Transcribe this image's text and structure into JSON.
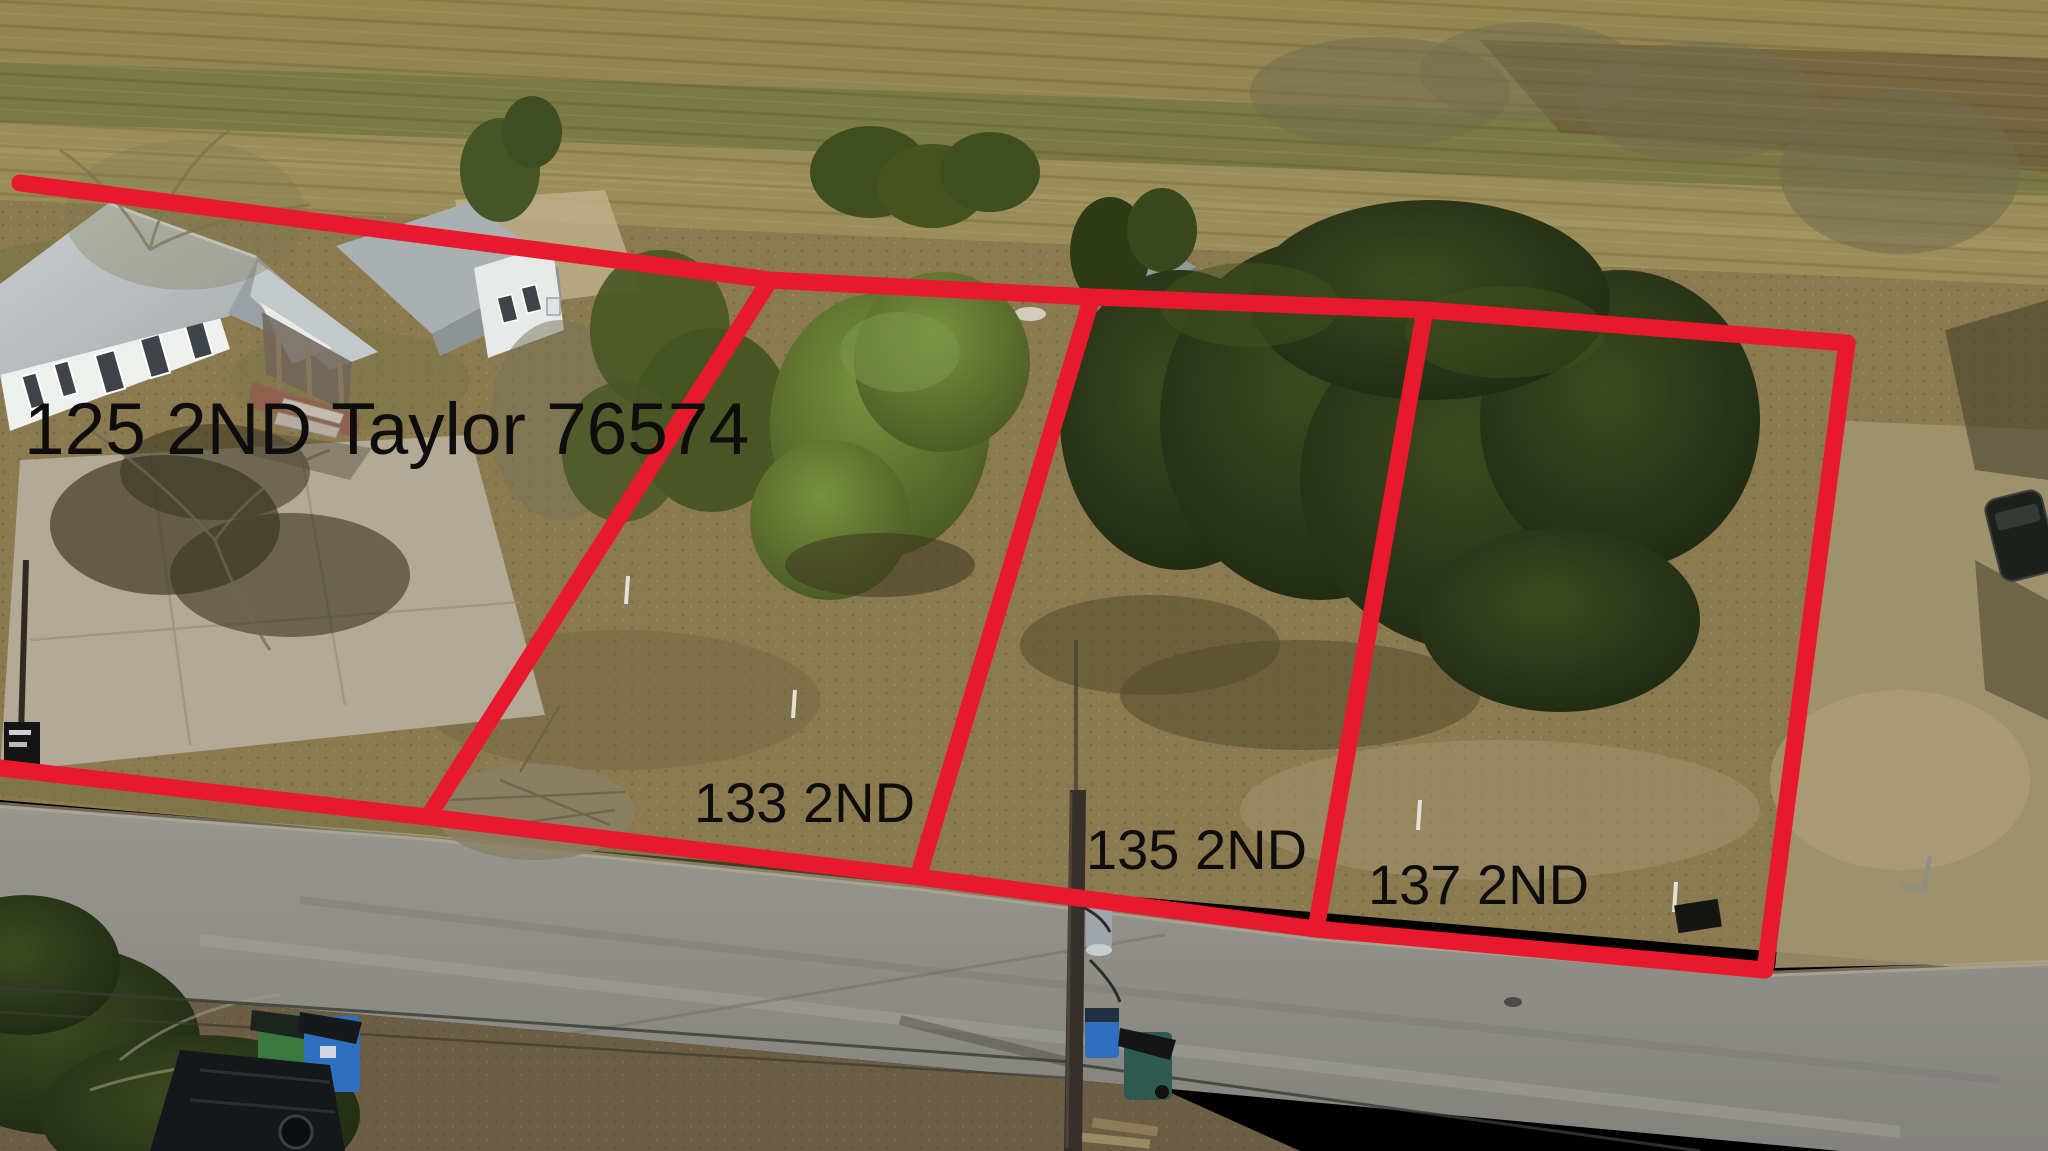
{
  "annotation": {
    "line_color": "#e8192c",
    "line_width": 17,
    "label_color": "#0d0d0d",
    "labels": [
      {
        "id": "lot-125",
        "text": "125 2ND Taylor 76574",
        "x": 24,
        "y": 392,
        "font_size": 73
      },
      {
        "id": "lot-133",
        "text": "133 2ND",
        "x": 694,
        "y": 774,
        "font_size": 56
      },
      {
        "id": "lot-135",
        "text": "135 2ND",
        "x": 1086,
        "y": 821,
        "font_size": 56
      },
      {
        "id": "lot-137",
        "text": "137 2ND",
        "x": 1368,
        "y": 856,
        "font_size": 56
      }
    ],
    "boundaries": [
      {
        "name": "top-boundary",
        "points": [
          [
            20,
            183
          ],
          [
            770,
            280
          ],
          [
            1092,
            297
          ],
          [
            1425,
            310
          ],
          [
            1847,
            343
          ]
        ]
      },
      {
        "name": "divider-125-133",
        "points": [
          [
            770,
            280
          ],
          [
            428,
            817
          ]
        ]
      },
      {
        "name": "divider-133-135",
        "points": [
          [
            1092,
            297
          ],
          [
            918,
            877
          ]
        ]
      },
      {
        "name": "divider-135-137",
        "points": [
          [
            1425,
            310
          ],
          [
            1316,
            929
          ]
        ]
      },
      {
        "name": "right-boundary",
        "points": [
          [
            1847,
            343
          ],
          [
            1765,
            970
          ]
        ]
      },
      {
        "name": "bottom-boundary",
        "points": [
          [
            0,
            768
          ],
          [
            428,
            817
          ],
          [
            918,
            877
          ],
          [
            1316,
            929
          ],
          [
            1765,
            970
          ]
        ]
      }
    ]
  }
}
